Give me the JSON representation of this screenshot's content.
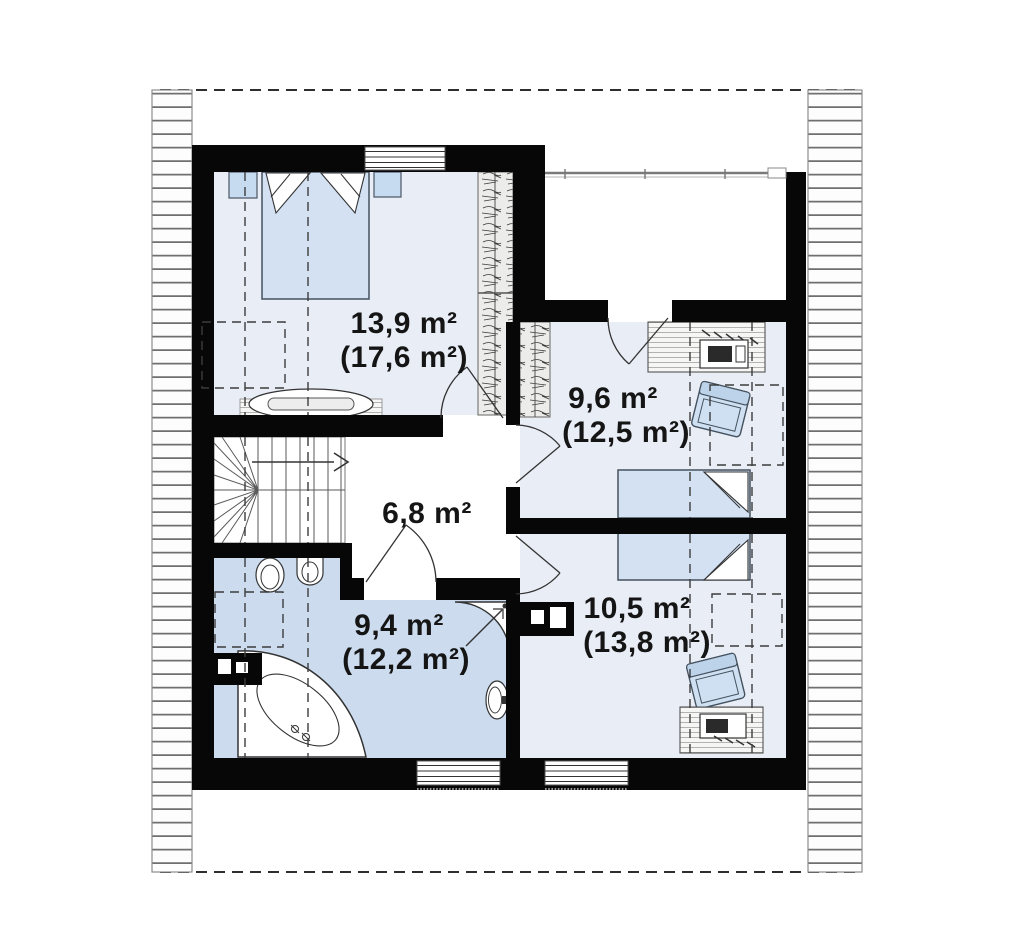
{
  "document": {
    "kind": "attic-floor-plan",
    "units": "m²"
  },
  "palette": {
    "wall_black": "#070707",
    "room_floor_blue": "#e9edf6",
    "bathroom_floor_blue": "#ccdcee",
    "furniture_blue": "#d3e1f3",
    "nightstand_blue": "#c6daf0",
    "hatch_gray": "#6f6f6f",
    "dash_gray": "#3c3c3c",
    "label_text": "#151515",
    "white": "#ffffff"
  },
  "rooms": [
    {
      "id": "bedroom-top-left",
      "area_label": "13,9 m²",
      "gross_label": "(17,6 m²)",
      "furniture": [
        "double-bed",
        "nightstand",
        "nightstand",
        "wardrobe",
        "dresser"
      ]
    },
    {
      "id": "room-right-top",
      "area_label": "9,6 m²",
      "gross_label": "(12,5 m²)",
      "furniture": [
        "wardrobe",
        "desk",
        "desk-chair",
        "armchair",
        "single-bed"
      ]
    },
    {
      "id": "hall-center",
      "area_label": "6,8 m²",
      "gross_label": "",
      "furniture": [
        "winder-staircase"
      ]
    },
    {
      "id": "bathroom-bottom-left",
      "area_label": "9,4 m²",
      "gross_label": "(12,2 m²)",
      "furniture": [
        "toilet",
        "bidet",
        "corner-bathtub",
        "corner-shower",
        "washbasin",
        "chimney-duct"
      ]
    },
    {
      "id": "room-right-bottom",
      "area_label": "10,5 m²",
      "gross_label": "(13,8 m²)",
      "furniture": [
        "single-bed",
        "armchair",
        "desk",
        "desk-chair",
        "chimney-duct"
      ]
    }
  ],
  "symbols": {
    "roof_edge": "hatched-strip",
    "roof_outline": "dashed-line",
    "headroom_guides": "dashed-lines",
    "windows": 3,
    "door_swings": 5,
    "stair_direction": "arrow-right"
  }
}
